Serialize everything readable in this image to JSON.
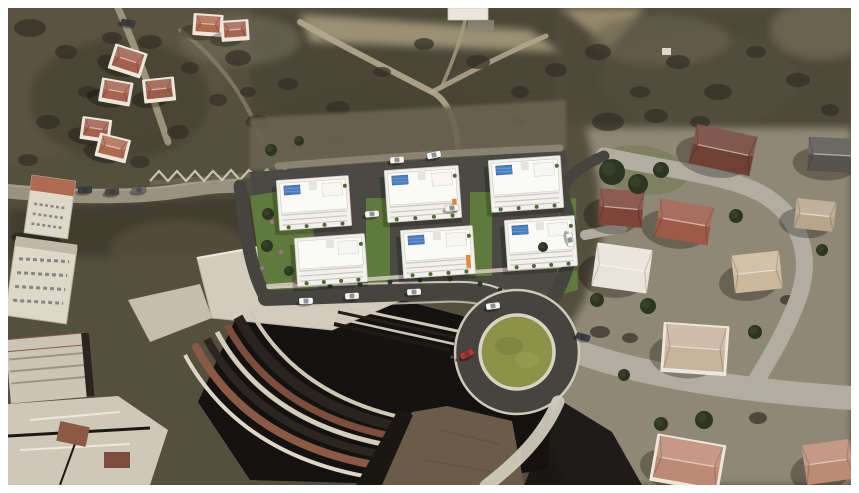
{
  "image": {
    "kind": "aerial-architectural-render",
    "width": 859,
    "height": 493,
    "frame_margin_px": 8
  },
  "palette": {
    "frame": "#ffffff",
    "terrain_base": "#55503e",
    "ground_right": "#8f8874",
    "clearing_tan": "#a3987a",
    "path_tan": "#b3a88e",
    "bush_dark": "#332f26",
    "tree_green": "#2c3522",
    "lawn_right": "#7c7f5d",
    "asphalt_new": "#45443f",
    "asphalt_platform": "#4a4943",
    "street_light": "#b1ada1",
    "street_dim": "#8a8372",
    "curb_light": "#cfc9ba",
    "roundabout_green": "#8e9148",
    "cobble_brown": "#6b5c49",
    "building_white": "#f2f1ec",
    "roof_detail": "#fafaf7",
    "solar_blue": "#4a7fc1",
    "accent_orange": "#d98f3a",
    "garden_green": "#5f7a3c",
    "planter_green": "#4d6b33",
    "flower_pink": "#b56a8c",
    "shadow_dark": "#141210",
    "brick_red": "#8a5a44",
    "facade_light": "#ded8ca",
    "roof_plate": "#d3ccbd",
    "car_red": "#c03530",
    "car_dark": "#3c3e42",
    "car_white": "#f5f5f2"
  },
  "scene": {
    "new_development": {
      "block_count": 6,
      "blocks": [
        {
          "x": 278,
          "y": 178,
          "w": 72,
          "h": 50,
          "solar": true,
          "accent": false
        },
        {
          "x": 386,
          "y": 168,
          "w": 74,
          "h": 52,
          "solar": true,
          "accent": true
        },
        {
          "x": 490,
          "y": 158,
          "w": 72,
          "h": 52,
          "solar": true,
          "accent": false
        },
        {
          "x": 296,
          "y": 236,
          "w": 70,
          "h": 48,
          "solar": false,
          "accent": false
        },
        {
          "x": 402,
          "y": 228,
          "w": 72,
          "h": 48,
          "solar": true,
          "accent": true
        },
        {
          "x": 506,
          "y": 218,
          "w": 70,
          "h": 50,
          "solar": true,
          "accent": false
        }
      ]
    },
    "roundabout": {
      "cx": 517,
      "cy": 352,
      "outer_r": 62,
      "green_r": 37
    },
    "hill_houses": [
      {
        "x": 114,
        "y": 50,
        "w": 28,
        "h": 20,
        "rot": 18,
        "roof": "#a3604c",
        "walls": true
      },
      {
        "x": 103,
        "y": 82,
        "w": 26,
        "h": 18,
        "rot": 10,
        "roof": "#a86450",
        "walls": true
      },
      {
        "x": 146,
        "y": 80,
        "w": 26,
        "h": 18,
        "rot": -6,
        "roof": "#9c5e4a",
        "walls": true
      },
      {
        "x": 84,
        "y": 120,
        "w": 24,
        "h": 17,
        "rot": 8,
        "roof": "#a3604c",
        "walls": true
      },
      {
        "x": 100,
        "y": 138,
        "w": 26,
        "h": 18,
        "rot": 14,
        "roof": "#b06a50",
        "walls": true
      },
      {
        "x": 196,
        "y": 16,
        "w": 24,
        "h": 16,
        "rot": 4,
        "roof": "#b06a50",
        "walls": true
      },
      {
        "x": 224,
        "y": 22,
        "w": 22,
        "h": 15,
        "rot": -4,
        "roof": "#a86450",
        "walls": true
      }
    ],
    "neighborhood_houses": [
      {
        "x": 692,
        "y": 130,
        "w": 62,
        "h": 40,
        "rot": 12,
        "roof": "#6f4034",
        "walls": false
      },
      {
        "x": 657,
        "y": 203,
        "w": 54,
        "h": 38,
        "rot": 10,
        "roof": "#9c5a47",
        "walls": false
      },
      {
        "x": 599,
        "y": 190,
        "w": 44,
        "h": 36,
        "rot": 5,
        "roof": "#7d4437",
        "walls": false
      },
      {
        "x": 594,
        "y": 246,
        "w": 56,
        "h": 44,
        "rot": 8,
        "roof": "#e8e4da",
        "walls": false
      },
      {
        "x": 733,
        "y": 253,
        "w": 48,
        "h": 38,
        "rot": -6,
        "roof": "#cbb89d",
        "walls": false
      },
      {
        "x": 665,
        "y": 326,
        "w": 60,
        "h": 44,
        "rot": 4,
        "roof": "#c7b49b",
        "walls": true
      },
      {
        "x": 656,
        "y": 441,
        "w": 64,
        "h": 42,
        "rot": 10,
        "roof": "#bd8a74",
        "walls": true
      },
      {
        "x": 804,
        "y": 442,
        "w": 48,
        "h": 40,
        "rot": -8,
        "roof": "#bd8a74",
        "walls": false
      },
      {
        "x": 808,
        "y": 138,
        "w": 52,
        "h": 34,
        "rot": 3,
        "roof": "#55534c",
        "walls": false
      },
      {
        "x": 795,
        "y": 200,
        "w": 40,
        "h": 30,
        "rot": 6,
        "roof": "#b8a68c",
        "walls": false
      }
    ],
    "trees": [
      [
        612,
        172,
        13
      ],
      [
        638,
        184,
        10
      ],
      [
        661,
        170,
        8
      ],
      [
        597,
        300,
        7
      ],
      [
        648,
        306,
        8
      ],
      [
        736,
        216,
        7
      ],
      [
        704,
        420,
        9
      ],
      [
        661,
        424,
        7
      ],
      [
        271,
        150,
        6
      ],
      [
        299,
        141,
        5
      ],
      [
        268,
        214,
        6
      ],
      [
        267,
        246,
        6
      ],
      [
        289,
        271,
        5
      ],
      [
        543,
        247,
        5
      ],
      [
        755,
        332,
        7
      ],
      [
        624,
        375,
        6
      ],
      [
        822,
        250,
        6
      ]
    ],
    "bushes": [
      [
        30,
        28,
        16,
        9
      ],
      [
        66,
        52,
        11,
        7
      ],
      [
        112,
        38,
        10,
        6
      ],
      [
        150,
        42,
        12,
        7
      ],
      [
        190,
        68,
        9,
        6
      ],
      [
        238,
        58,
        13,
        8
      ],
      [
        288,
        84,
        10,
        6
      ],
      [
        338,
        108,
        12,
        7
      ],
      [
        382,
        72,
        9,
        5
      ],
      [
        424,
        44,
        10,
        6
      ],
      [
        478,
        62,
        12,
        7
      ],
      [
        520,
        92,
        9,
        6
      ],
      [
        556,
        70,
        11,
        7
      ],
      [
        598,
        52,
        13,
        8
      ],
      [
        640,
        92,
        10,
        6
      ],
      [
        678,
        62,
        12,
        7
      ],
      [
        718,
        92,
        14,
        8
      ],
      [
        756,
        52,
        10,
        6
      ],
      [
        798,
        80,
        12,
        7
      ],
      [
        830,
        110,
        9,
        6
      ],
      [
        608,
        122,
        16,
        9
      ],
      [
        656,
        116,
        12,
        7
      ],
      [
        700,
        122,
        10,
        6
      ],
      [
        258,
        122,
        12,
        7
      ],
      [
        218,
        100,
        9,
        6
      ],
      [
        178,
        132,
        11,
        7
      ],
      [
        88,
        92,
        10,
        6
      ],
      [
        48,
        122,
        12,
        7
      ],
      [
        140,
        162,
        10,
        6
      ],
      [
        738,
        140,
        12,
        7
      ],
      [
        336,
        140,
        9,
        5
      ],
      [
        518,
        120,
        8,
        5
      ],
      [
        600,
        332,
        10,
        6
      ],
      [
        630,
        338,
        8,
        5
      ],
      [
        758,
        418,
        9,
        6
      ],
      [
        788,
        300,
        8,
        5
      ],
      [
        28,
        160,
        10,
        6
      ],
      [
        248,
        92,
        8,
        5
      ]
    ],
    "cars": [
      {
        "x": 352,
        "y": 296,
        "rot": -3,
        "color": "#f5f5f2"
      },
      {
        "x": 414,
        "y": 292,
        "rot": -3,
        "color": "#f5f5f2"
      },
      {
        "x": 306,
        "y": 301,
        "rot": -2,
        "color": "#f5f5f2"
      },
      {
        "x": 372,
        "y": 214,
        "rot": -5,
        "color": "#f5f5f2"
      },
      {
        "x": 452,
        "y": 208,
        "rot": -5,
        "color": "#f5f5f2"
      },
      {
        "x": 397,
        "y": 160,
        "rot": -4,
        "color": "#f5f5f2"
      },
      {
        "x": 434,
        "y": 155,
        "rot": -12,
        "color": "#f5f5f2"
      },
      {
        "x": 570,
        "y": 240,
        "rot": 78,
        "color": "#f5f5f2"
      },
      {
        "x": 493,
        "y": 306,
        "rot": -8,
        "color": "#f5f5f2"
      },
      {
        "x": 467,
        "y": 354,
        "rot": -25,
        "color": "#c03530"
      },
      {
        "x": 583,
        "y": 337,
        "rot": 15,
        "color": "#3c3e42"
      },
      {
        "x": 85,
        "y": 190,
        "rot": -2,
        "color": "#3c3e42"
      },
      {
        "x": 112,
        "y": 192,
        "rot": -3,
        "color": "#4a4a46"
      },
      {
        "x": 139,
        "y": 190,
        "rot": -3,
        "color": "#6a6a66"
      },
      {
        "x": 128,
        "y": 23,
        "rot": 10,
        "color": "#3c3e42"
      }
    ],
    "people": [
      {
        "x": 452,
        "y": 357
      },
      {
        "x": 457,
        "y": 360
      }
    ]
  }
}
